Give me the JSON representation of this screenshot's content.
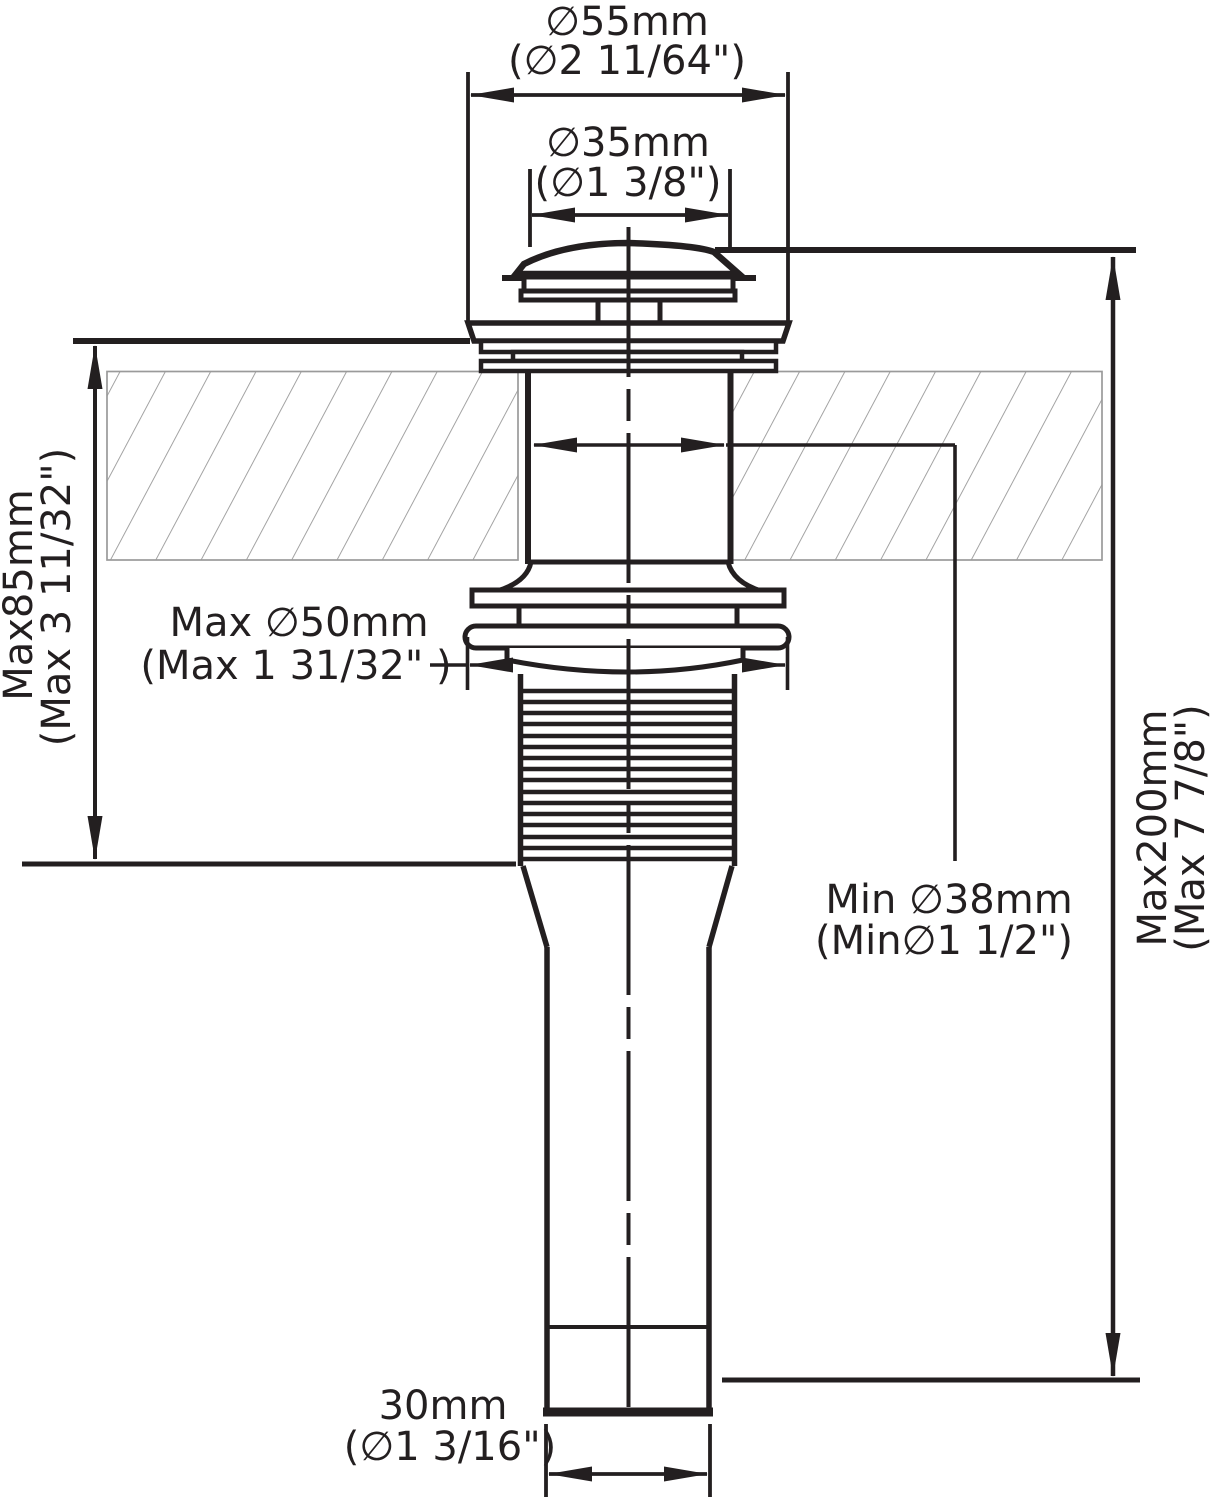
{
  "drawing": {
    "description": "Pop-up sink drain technical dimension drawing",
    "colors": {
      "line": "#231f20",
      "hatch": "#949494",
      "counter_border": "#9a9a9a",
      "background": "#ffffff"
    }
  },
  "dimensions": {
    "top_outer": {
      "metric": "∅55mm",
      "imperial": "(∅2  11/64\")"
    },
    "top_inner": {
      "metric": "∅35mm",
      "imperial": "(∅1  3/8\")"
    },
    "left_depth": {
      "metric": "Max85mm",
      "imperial": "(Max 3 11/32\")"
    },
    "washer_max": {
      "metric": "Max ∅50mm",
      "imperial": "(Max 1 31/32\" )"
    },
    "hole_min": {
      "metric": "Min ∅38mm",
      "imperial": "(Min∅1 1/2\")"
    },
    "right_length": {
      "metric": "Max200mm",
      "imperial": "(Max 7 7/8\")"
    },
    "bottom_outlet": {
      "metric": "30mm",
      "imperial": "(∅1 3/16\")"
    }
  }
}
